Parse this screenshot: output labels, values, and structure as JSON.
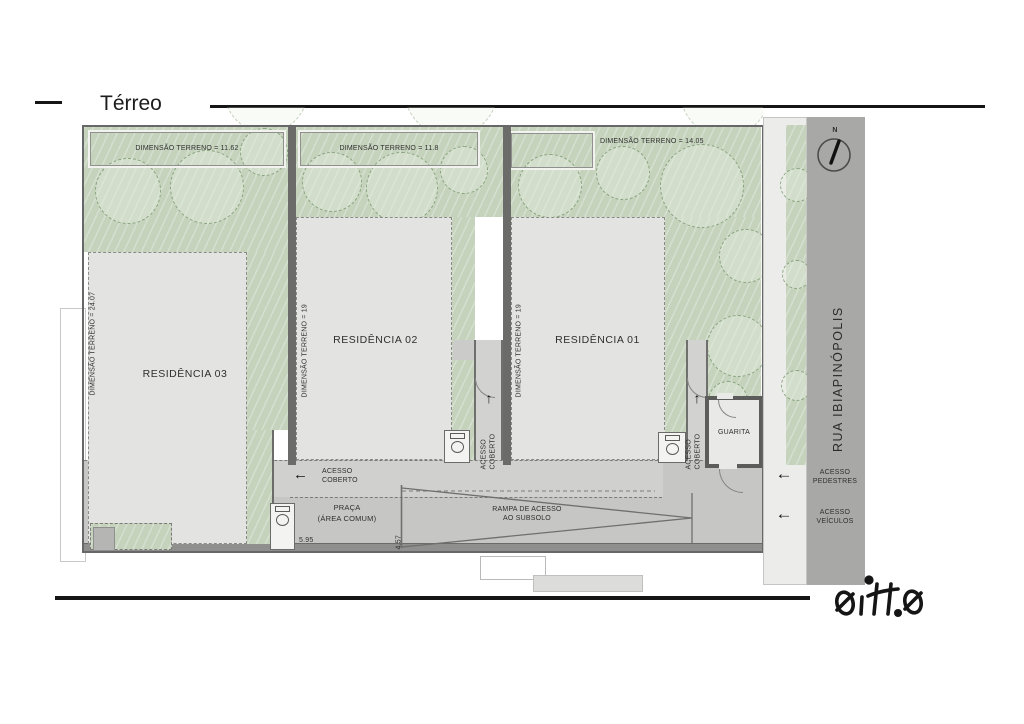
{
  "title": "Térreo",
  "plan": {
    "lots": [
      {
        "residence": "RESIDÊNCIA 03",
        "dimension_top": "DIMENSÃO TERRENO = 11.62",
        "dimension_side": "DIMENSÃO TERRENO = 24.07"
      },
      {
        "residence": "RESIDÊNCIA 02",
        "dimension_top": "DIMENSÃO TERRENO = 11.8",
        "dimension_side": "DIMENSÃO TERRENO = 19"
      },
      {
        "residence": "RESIDÊNCIA 01",
        "dimension_top": "DIMENSÃO TERRENO = 14.05",
        "dimension_side": "DIMENSÃO TERRENO = 19"
      }
    ],
    "labels": {
      "acesso_l1": "ACESSO",
      "acesso_l2": "COBERTO",
      "guarita": "GUARITA",
      "praca_l1": "PRAÇA",
      "praca_l2": "(ÁREA COMUM)",
      "rampa_l1": "RAMPA DE ACESSO",
      "rampa_l2": "AO SUBSOLO",
      "dim_595": "5.95",
      "dim_457": "4.57"
    }
  },
  "street": {
    "name": "RUA IBIAPINÓPOLIS",
    "north": "N",
    "pedestres_l1": "ACESSO",
    "pedestres_l2": "PEDESTRES",
    "veiculos_l1": "ACESSO",
    "veiculos_l2": "VEÍCULOS"
  },
  "icons": {
    "left_arrow": "←",
    "up_arrow": "↑"
  },
  "logo": {
    "text": "oitto"
  },
  "colors": {
    "green": "#c5d3bd",
    "building": "#e3e3e1",
    "street": "#a8a8a6",
    "wall": "#6b6b69",
    "band": "#c6c6c4"
  }
}
